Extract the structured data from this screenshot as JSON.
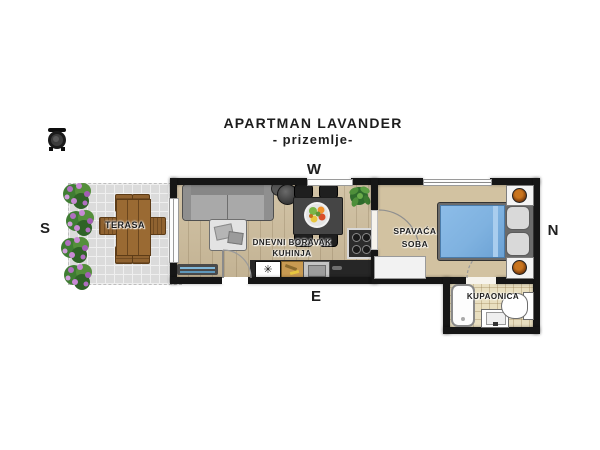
{
  "header": {
    "title": "APARTMAN LAVANDER",
    "subtitle": "- prizemlje-"
  },
  "compass": {
    "west": "W",
    "east": "E",
    "south": "S",
    "north": "N"
  },
  "rooms": {
    "terrace": {
      "label": "TERASA"
    },
    "living_kitchen": {
      "label_line1": "DNEVNI BORAVAK",
      "label_line2": "KUHINJA"
    },
    "bedroom": {
      "label_line1": "SPAVAĆA",
      "label_line2": "SOBA"
    },
    "bathroom": {
      "label": "KUPAONICA"
    }
  },
  "kitchen": {
    "fridge_symbol": "✳"
  },
  "icons": {
    "grill": "grill-icon",
    "terrace_plants": "flower-bush-icon",
    "indoor_plant": "plant-icon",
    "fruit_plate": "fruit-plate-icon"
  },
  "colors": {
    "wall": "#161616",
    "wood_floor": "#cdbc9b",
    "terrace_tile": "#dbdbdb",
    "bathroom_tile": "#e9dfc0",
    "bed_blue": "#7fb2e0",
    "furniture_brown": "#8f6230",
    "text": "#1d1d1d"
  }
}
